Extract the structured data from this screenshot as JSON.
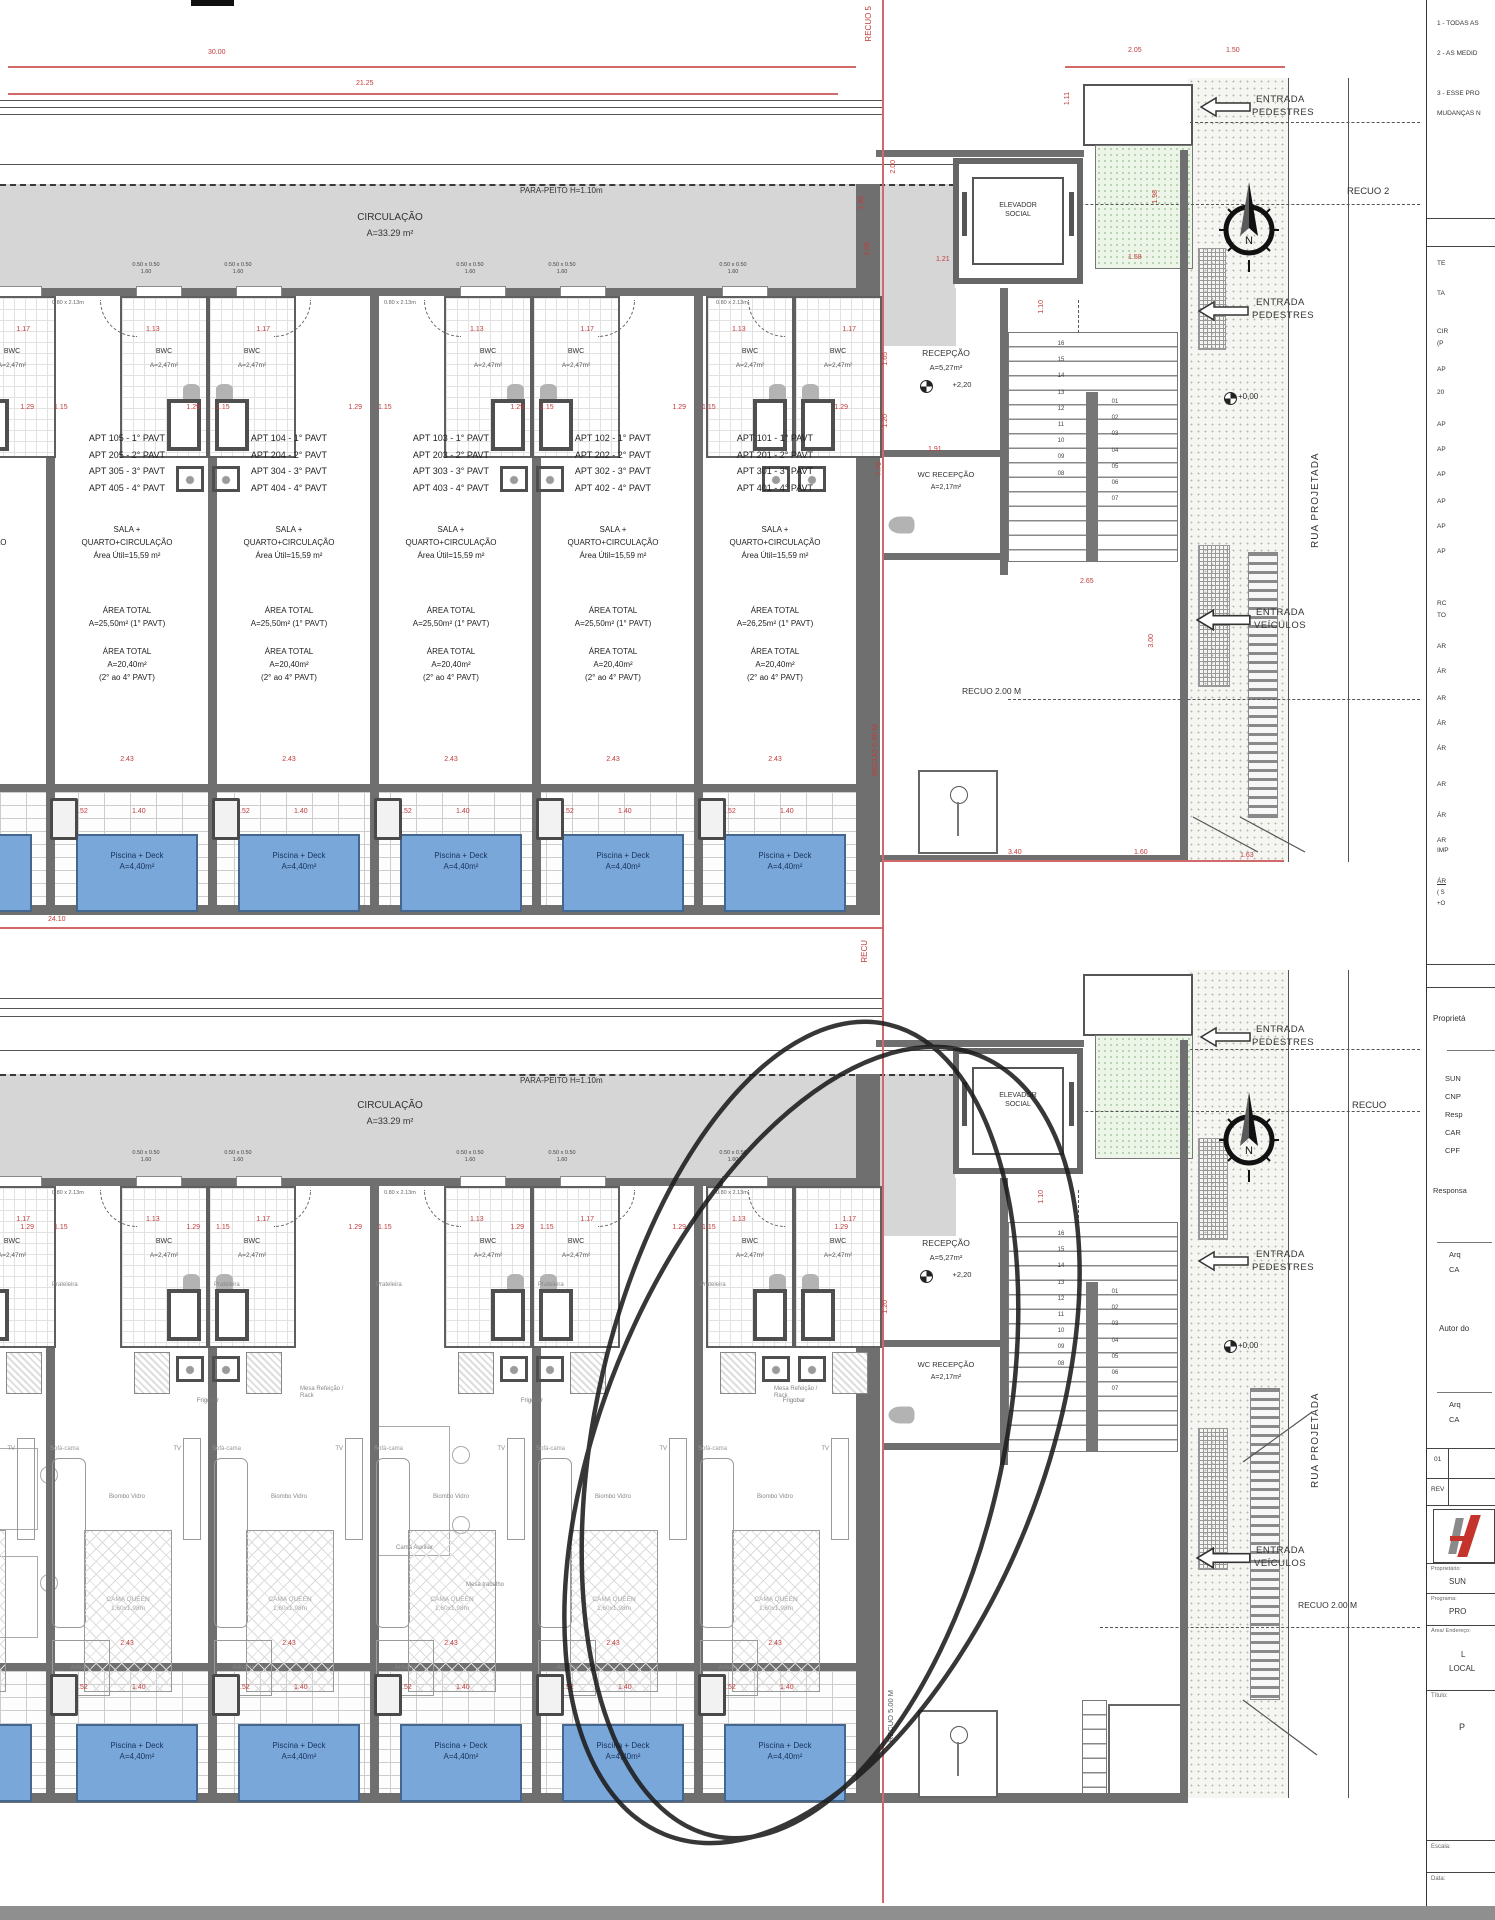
{
  "dims": {
    "d3000": "30.00",
    "d2125": "21.25",
    "d205": "2.05",
    "d150": "1.50",
    "d185": "1.85",
    "d200": "2.00",
    "d106": "1.06",
    "d121": "1.21",
    "d191": "1.91",
    "d165": "1.65",
    "d120": "1.20",
    "d110": "1.10",
    "d265": "2.65",
    "d770": "7.70",
    "d158": "1.58",
    "d111": "1.11",
    "d198": "1.98",
    "d300": "3.00",
    "d340": "3.40",
    "d160": "1.60",
    "d163": "1.63",
    "d2410": "24.10",
    "d113": "1.13",
    "d117": "1.17",
    "d115": "1.15",
    "d129": "1.29",
    "d243": "2.43",
    "d052": ".52",
    "d140": "1.40",
    "win_a": "0.50 x 0.50",
    "win_b": "1.60",
    "door": "0.80 x 2.13m"
  },
  "street": {
    "entrada1": "ENTRADA",
    "entrada2": "PEDESTRES",
    "veiculos1": "ENTRADA",
    "veiculos2": "VEÍCULOS",
    "recuo2": "RECUO 2",
    "recuo": "RECUO",
    "recuo200": "RECUO 2.00 M",
    "recuo500": "RECUO 5.00 M",
    "recuo5": "RECUO 5",
    "recu": "RECU",
    "rua": "RUA PROJETADA",
    "nivel0": "+0,00"
  },
  "plan1": {
    "parapeito": "PARA-PEITO H=1.10m",
    "circ": "CIRCULAÇÃO",
    "circ_area": "A=33.29 m²",
    "bwc": "BWC",
    "bwc_area": "A=2,47m²",
    "sala1": "SALA +",
    "sala2": "QUARTO+CIRCULAÇÃO",
    "sala3": "Área Útil=15,59 m²",
    "area_total": "ÁREA TOTAL",
    "at2a": "A=20,40m²",
    "at2b": "(2° ao 4° PAVT)",
    "pool1": "Piscina + Deck",
    "pool2": "A=4,40m²",
    "recepcao": "RECEPÇÃO",
    "recepcao_area": "A=5,27m²",
    "recepcao_nivel": "+2,20",
    "wc": "WC RECEPÇÃO",
    "wc_area": "A=2,17m²",
    "elev1": "ELEVADOR",
    "elev2": "SOCIAL",
    "stairs_l": [
      "16",
      "15",
      "14",
      "13",
      "12",
      "11",
      "10",
      "09",
      "08"
    ],
    "stairs_r": [
      "01",
      "02",
      "03",
      "04",
      "05",
      "06",
      "07"
    ],
    "units": [
      {
        "x": -120,
        "l1": "APT 106 - 1° PAVT",
        "l2": "APT 206 - 2° PAVT",
        "l3": "APT 306 - 3° PAVT",
        "l4": "APT 406 - 4° PAVT",
        "at1": "A=25,50m² (1° PAVT)"
      },
      {
        "x": 46,
        "l1": "APT 105 - 1° PAVT",
        "l2": "APT 205 - 2° PAVT",
        "l3": "APT 305 - 3° PAVT",
        "l4": "APT 405 - 4° PAVT",
        "at1": "A=25,50m² (1° PAVT)"
      },
      {
        "x": 208,
        "l1": "APT 104 - 1° PAVT",
        "l2": "APT 204 - 2° PAVT",
        "l3": "APT 304 - 3° PAVT",
        "l4": "APT 404 - 4° PAVT",
        "at1": "A=25,50m² (1° PAVT)"
      },
      {
        "x": 370,
        "l1": "APT 103 - 1° PAVT",
        "l2": "APT 203 - 2° PAVT",
        "l3": "APT 303 - 3° PAVT",
        "l4": "APT 403 - 4° PAVT",
        "at1": "A=25,50m² (1° PAVT)"
      },
      {
        "x": 532,
        "l1": "APT 102 - 1° PAVT",
        "l2": "APT 202 - 2° PAVT",
        "l3": "APT 302 - 3° PAVT",
        "l4": "APT 402 - 4° PAVT",
        "at1": "A=25,50m² (1° PAVT)"
      },
      {
        "x": 694,
        "l1": "APT 101 - 1° PAVT",
        "l2": "APT 201 - 2° PAVT",
        "l3": "APT 301 - 3° PAVT",
        "l4": "APT 401 - 4° PAVT",
        "at1": "A=26,25m² (1° PAVT)"
      }
    ],
    "pairs": [
      {
        "x": -120
      },
      {
        "x": 120
      },
      {
        "x": 444
      },
      {
        "x": 706
      }
    ],
    "windows": [
      {
        "x": 118
      },
      {
        "x": 210
      },
      {
        "x": 442
      },
      {
        "x": 534
      },
      {
        "x": 705
      }
    ],
    "doors": [
      {
        "x": 52
      },
      {
        "x": 384
      },
      {
        "x": 716
      }
    ]
  },
  "plan2": {
    "furn": {
      "prateleira": "Prateleira",
      "frigobar": "Frigobar",
      "sofa": "Sofá-cama",
      "biombo": "Biombo Vidro",
      "cama1": "CAMA QUEEN",
      "cama2": "1,60x1,98m",
      "cama_aux": "Cama Auxiliar",
      "mesa_rack": "Mesa Refeição / Rack",
      "mesa_trab": "Mesa trabalho",
      "armario": "Armário",
      "tv": "TV"
    },
    "units": [
      {
        "x": -120
      },
      {
        "x": 46
      },
      {
        "x": 208
      },
      {
        "x": 370
      },
      {
        "x": 532
      },
      {
        "x": 694
      }
    ],
    "pairs": [
      {
        "x": -120
      },
      {
        "x": 120
      },
      {
        "x": 444
      },
      {
        "x": 706
      }
    ],
    "windows": [
      {
        "x": 118
      },
      {
        "x": 210
      },
      {
        "x": 442
      },
      {
        "x": 534
      },
      {
        "x": 705
      }
    ],
    "doors": [
      {
        "x": 52
      },
      {
        "x": 384
      },
      {
        "x": 716
      }
    ]
  },
  "titleblock": {
    "notes": [
      "1 - TODAS AS",
      "2 - AS MEDID",
      "3 - ESSE PRO",
      "MUDANÇAS N"
    ],
    "legend": [
      "TE",
      "TA",
      "CIR",
      "(P",
      "AP",
      "20",
      "AP",
      "AP",
      "AP",
      "AP",
      "AP",
      "AP",
      "RC",
      "TO",
      "AR",
      "ÁR",
      "AR",
      "ÁR",
      "ÁR",
      "AR",
      "ÁR",
      "AR",
      "IMP",
      "ÁR",
      "( S",
      "+O"
    ],
    "prop_cut": "Proprietá",
    "sun": "SUN",
    "cnp": "CNP",
    "resp": "Resp",
    "car": "CAR",
    "cpf": "CPF",
    "responsa": "Responsa",
    "arq": "Arq",
    "ca": "CA",
    "autor": "Autor do",
    "rev_num": "01",
    "rev": "REV",
    "proprietario_lbl": "Proprietário:",
    "programa_lbl": "Programa:",
    "programa": "PRO",
    "endereco_lbl": "Área/ Endereço:",
    "end1": "L",
    "end2": "LOCAL",
    "titulo_lbl": "Título:",
    "titulo": "P",
    "escala_lbl": "Escala:",
    "data_lbl": "Data:"
  }
}
